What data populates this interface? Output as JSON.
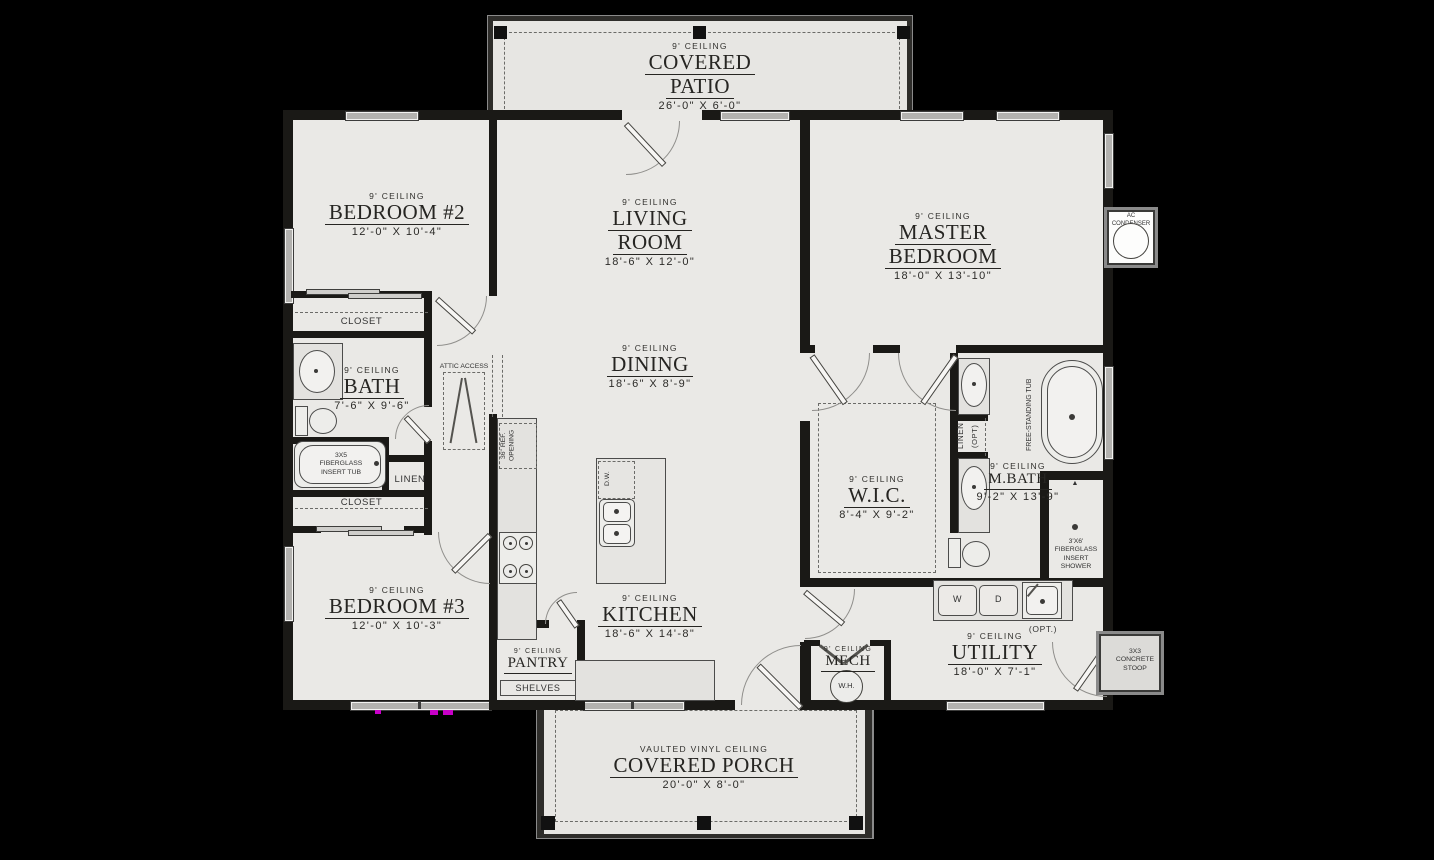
{
  "patio": {
    "ceiling": "9' CEILING",
    "line1": "COVERED",
    "line2": "PATIO",
    "dims": "26'-0\" X 6'-0\""
  },
  "rooms": {
    "bedroom2": {
      "ceiling": "9' CEILING",
      "name": "BEDROOM #2",
      "dims": "12'-0\" X 10'-4\""
    },
    "living": {
      "ceiling": "9' CEILING",
      "line1": "LIVING",
      "line2": "ROOM",
      "dims": "18'-6\" X 12'-0\""
    },
    "master": {
      "ceiling": "9' CEILING",
      "line1": "MASTER",
      "line2": "BEDROOM",
      "dims": "18'-0\" X 13'-10\""
    },
    "bath": {
      "ceiling": "9' CEILING",
      "name": "BATH",
      "dims": "7'-6\" X 9'-6\""
    },
    "dining": {
      "ceiling": "9' CEILING",
      "name": "DINING",
      "dims": "18'-6\" X 8'-9\""
    },
    "wic": {
      "ceiling": "9' CEILING",
      "name": "W.I.C.",
      "dims": "8'-4\" X 9'-2\""
    },
    "mbath": {
      "ceiling": "9' CEILING",
      "name": "M.BATH",
      "dims": "9'-2\" X 13'-9\""
    },
    "bedroom3": {
      "ceiling": "9' CEILING",
      "name": "BEDROOM #3",
      "dims": "12'-0\" X 10'-3\""
    },
    "kitchen": {
      "ceiling": "9' CEILING",
      "name": "KITCHEN",
      "dims": "18'-6\" X 14'-8\""
    },
    "pantry": {
      "ceiling": "9' CEILING",
      "name": "PANTRY"
    },
    "mech": {
      "ceiling": "9' CEILING",
      "name": "MECH"
    },
    "utility": {
      "ceiling": "9' CEILING",
      "name": "UTILITY",
      "dims": "18'-0\" X 7'-1\""
    }
  },
  "porch": {
    "ceiling": "VAULTED VINYL CEILING",
    "name": "COVERED PORCH",
    "dims": "20'-0\" X 8'-0\""
  },
  "ann": {
    "closet_bed2": "CLOSET",
    "closet_bed3": "CLOSET",
    "linen_bath": "LINEN",
    "shelves": "SHELVES",
    "attic": "ATTIC ACCESS",
    "ref1": "36\" REF.",
    "ref2": "OPENING",
    "dw": "D.W.",
    "wh": "W.H.",
    "washer": "W",
    "dryer": "D",
    "opt_sink": "(OPT.)",
    "tub1": "3X5",
    "tub2": "FIBERGLASS",
    "tub3": "INSERT TUB",
    "shower1": "3'X6'",
    "shower2": "FIBERGLASS",
    "shower3": "INSERT",
    "shower4": "SHOWER",
    "free_tub": "FREE-STANDING TUB",
    "linen_master": "LINEN",
    "linen_opt": "(OPT)",
    "ac": "AC CONDENSER",
    "stoop1": "3X3",
    "stoop2": "CONCRETE",
    "stoop3": "STOOP"
  },
  "colors": {
    "background": "#000000",
    "wall": "#1a1916",
    "floor": "#eae9e6",
    "outdoor_floor": "#e7e6e3",
    "window": "#b3b2af",
    "artifact": "#c800c8"
  }
}
